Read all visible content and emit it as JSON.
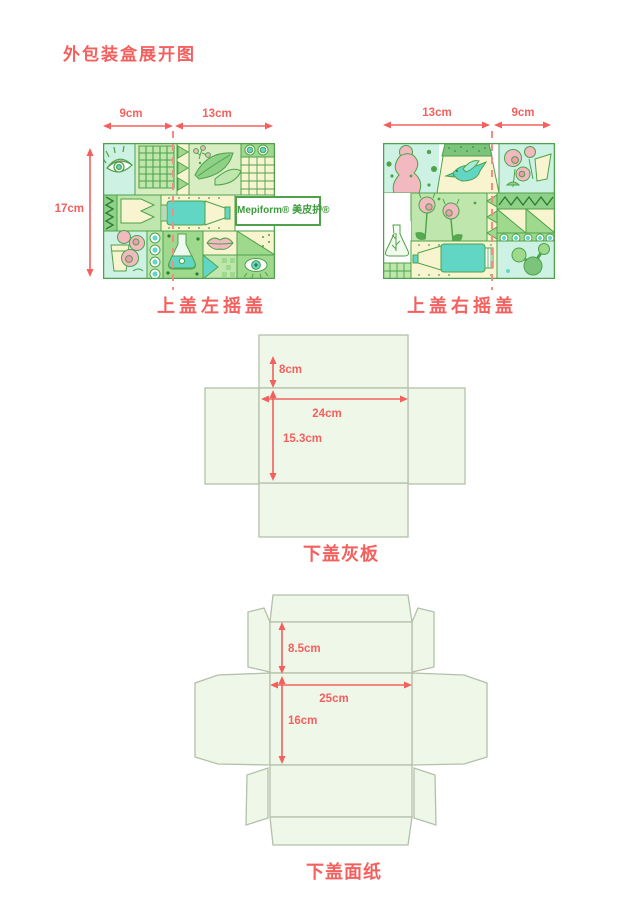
{
  "title": "外包装盒展开图",
  "colors": {
    "accent_red": "#f4605e",
    "fold_dash_red": "#f58b86",
    "dieline_fill": "#eef7e8",
    "dieline_stroke": "#b3c0aa",
    "artwork_green": "#4ea24a",
    "artwork_teal": "#62d6c5",
    "artwork_pink": "#f3b9c1"
  },
  "top_left_panel": {
    "dim_left": "9cm",
    "dim_right": "13cm",
    "dim_height": "17cm",
    "brand_label": "Mepiform® 美皮护®",
    "caption": "上盖左摇盖"
  },
  "top_right_panel": {
    "dim_left": "13cm",
    "dim_right": "9cm",
    "caption": "上盖右摇盖"
  },
  "grey_board": {
    "caption": "下盖灰板",
    "dim_flap": "8cm",
    "dim_width": "24cm",
    "dim_height": "15.3cm"
  },
  "face_paper": {
    "caption": "下盖面纸",
    "dim_flap": "8.5cm",
    "dim_width": "25cm",
    "dim_height": "16cm"
  }
}
